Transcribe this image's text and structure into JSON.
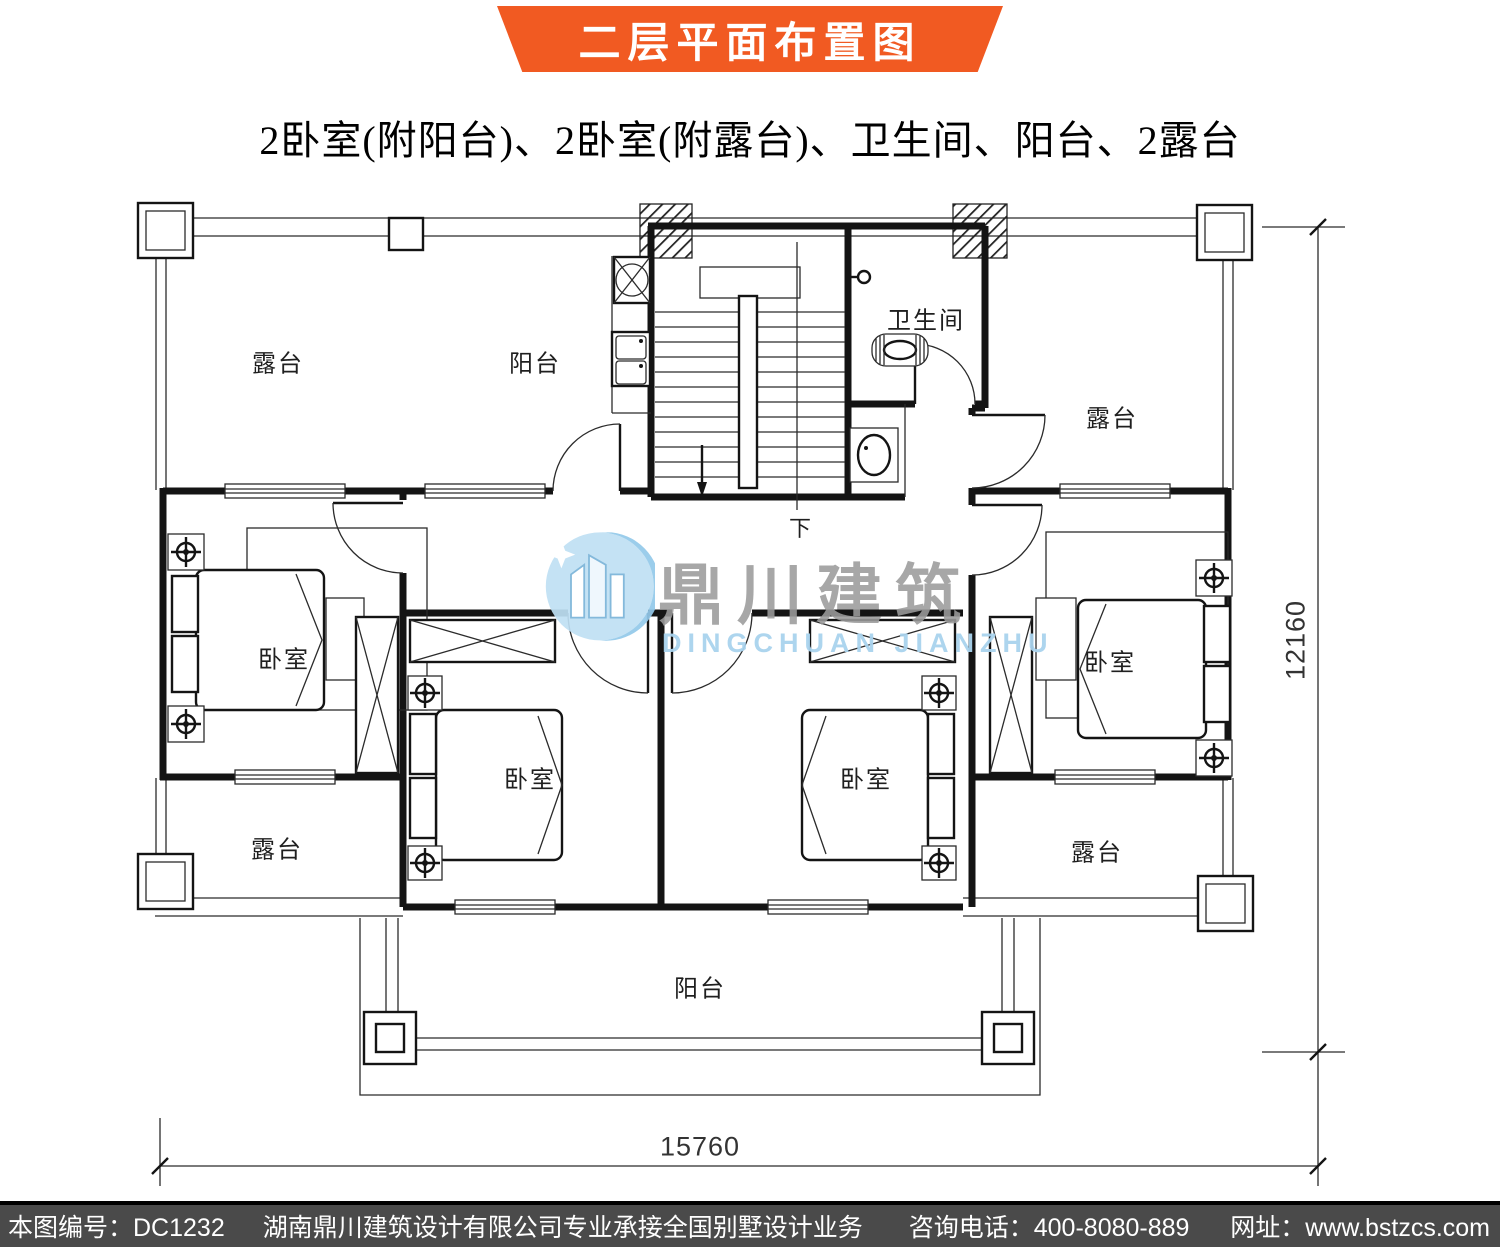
{
  "banner": {
    "title": "二层平面布置图",
    "background": "#f15a22",
    "text_color": "#ffffff"
  },
  "subtitle": "2卧室(附阳台)、2卧室(附露台)、卫生间、阳台、2露台",
  "plan": {
    "rooms": {
      "terrace_top_left": "露台",
      "balcony_top": "阳台",
      "bathroom": "卫生间",
      "terrace_top_right": "露台",
      "bedroom_left": "卧室",
      "bedroom_center_left": "卧室",
      "bedroom_center_right": "卧室",
      "bedroom_right": "卧室",
      "terrace_bottom_left": "露台",
      "terrace_bottom_right": "露台",
      "balcony_bottom": "阳台",
      "stairs_down_label": "下"
    },
    "dimensions": {
      "overall_width_mm": "15760",
      "overall_depth_mm": "12160"
    }
  },
  "watermark": {
    "name_cn": "鼎川建筑",
    "name_en": "DINGCHUAN JIANZHU",
    "color_blue": "#a9d3ee",
    "color_gray": "#9b9b9b"
  },
  "footer": {
    "drawing_number": "本图编号：DC1232",
    "company_line": "湖南鼎川建筑设计有限公司专业承接全国别墅设计业务",
    "phone": "咨询电话：400-8080-889",
    "website": "网址：www.bstzcs.com",
    "background": "#4a4a4a"
  }
}
